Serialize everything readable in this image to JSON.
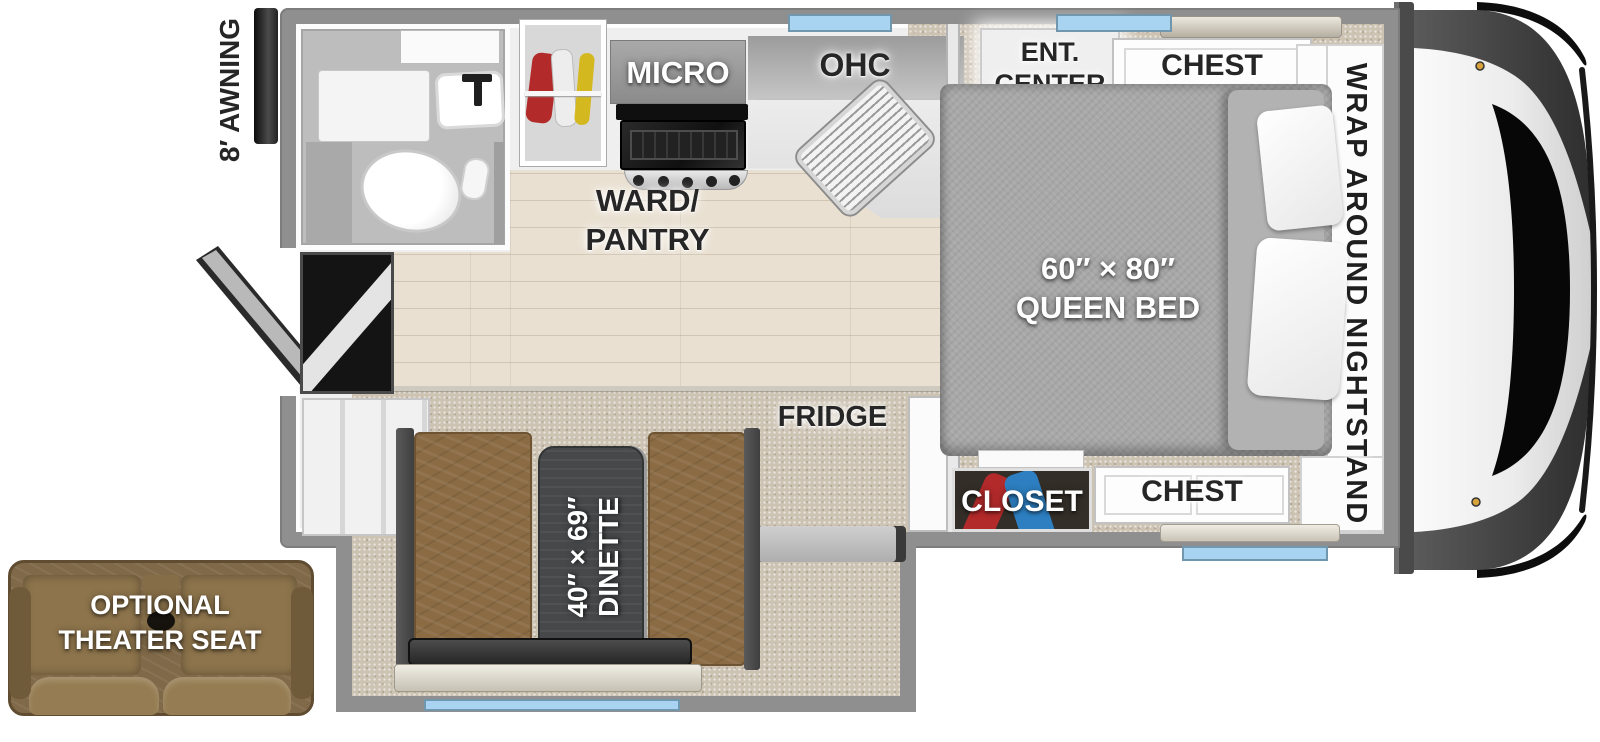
{
  "diagram": {
    "type": "rv-truck-camper-floorplan",
    "exterior": {
      "awning_label": "8′ AWNING",
      "theater_seat": {
        "line1": "OPTIONAL",
        "line2": "THEATER SEAT"
      }
    },
    "kitchen": {
      "micro_label": "MICRO",
      "ohc_label": "OHC",
      "ward_pantry": {
        "line1": "WARD/",
        "line2": "PANTRY"
      },
      "fridge_label": "FRIDGE"
    },
    "bedroom": {
      "ent_center": {
        "line1": "ENT.",
        "line2": "CENTER"
      },
      "chest_top_label": "CHEST",
      "chest_bottom_label": "CHEST",
      "closet_label": "CLOSET",
      "nightstand_label": "WRAP AROUND NIGHTSTAND",
      "queen_bed": {
        "line1": "60″ × 80″",
        "line2": "QUEEN BED"
      }
    },
    "dinette": {
      "line1": "40″ × 69″",
      "line2": "DINETTE"
    },
    "colors": {
      "wall_gray": "#8f8f8f",
      "window_blue": "#a8d4f1",
      "carpet": "#cdc3b3",
      "wood_floor": "#e9e0d1",
      "bed_gray": "#a8a8a8",
      "bench_brown": "#8a6b43",
      "table_charcoal": "#46484a",
      "tv_blue": "#2158c8",
      "clothes_red": "#b22a2a",
      "clothes_blue": "#2d7fc1",
      "clothes_yellow": "#d4b820",
      "awning_black": "#1c1c1c",
      "label_dark": "#262626",
      "label_light": "#ffffff"
    }
  }
}
